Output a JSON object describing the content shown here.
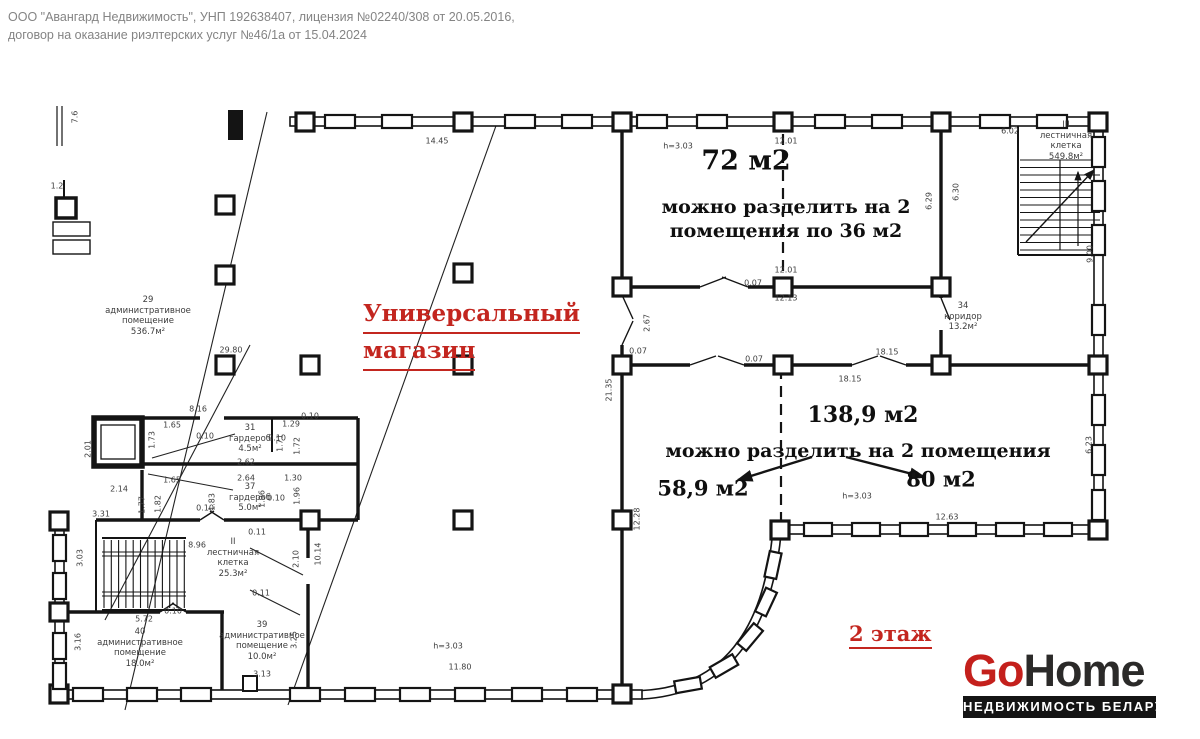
{
  "header": {
    "line1": "ООО \"Авангард Недвижимость\", УНП 192638407, лицензия №02240/308 от 20.05.2016,",
    "line2": "договор на оказание риэлтерских услуг №46/1а от 15.04.2024"
  },
  "colors": {
    "accent_red": "#c3261f",
    "logo_red": "#c4201c",
    "logo_dark": "#2b2a29",
    "line": "#141414",
    "tagline_bg": "#141414"
  },
  "plan": {
    "title": {
      "line1": "Универсальный",
      "line2": "магазин"
    },
    "floor_label": "2 этаж",
    "notes": [
      {
        "t": "72 м2",
        "x": 746,
        "y": 161,
        "s": 27
      },
      {
        "t": "можно разделить на 2",
        "x": 786,
        "y": 207,
        "s": 19
      },
      {
        "t": "помещения по 36 м2",
        "x": 786,
        "y": 231,
        "s": 19
      },
      {
        "t": "138,9 м2",
        "x": 863,
        "y": 415,
        "s": 22
      },
      {
        "t": "можно разделить на 2 помещения",
        "x": 858,
        "y": 451,
        "s": 19
      },
      {
        "t": "58,9 м2",
        "x": 703,
        "y": 488,
        "s": 21
      },
      {
        "t": "80 м2",
        "x": 941,
        "y": 479,
        "s": 21
      }
    ],
    "rooms": [
      {
        "x": 148,
        "y": 295,
        "lines": [
          "29",
          "административное",
          "помещение",
          "536.7м²"
        ]
      },
      {
        "x": 250,
        "y": 423,
        "lines": [
          "31",
          "гардероб",
          "4.5м²"
        ]
      },
      {
        "x": 250,
        "y": 482,
        "lines": [
          "37",
          "гардероб",
          "5.0м²"
        ]
      },
      {
        "x": 233,
        "y": 537,
        "lines": [
          "II",
          "лестничная",
          "клетка",
          "25.3м²"
        ]
      },
      {
        "x": 140,
        "y": 627,
        "lines": [
          "40",
          "административное",
          "помещение",
          "18.0м²"
        ]
      },
      {
        "x": 262,
        "y": 620,
        "lines": [
          "39",
          "административное",
          "помещение",
          "10.0м²"
        ]
      },
      {
        "x": 963,
        "y": 301,
        "lines": [
          "34",
          "коридор",
          "13.2м²"
        ]
      },
      {
        "x": 1066,
        "y": 120,
        "lines": [
          "III",
          "лестничная",
          "клетка",
          "549.8м²"
        ]
      }
    ],
    "dimensions": [
      {
        "t": "7.6",
        "x": 75,
        "y": 117,
        "r": 90
      },
      {
        "t": "1.2",
        "x": 57,
        "y": 186,
        "r": 0
      },
      {
        "t": "14.45",
        "x": 437,
        "y": 141,
        "r": 0
      },
      {
        "t": "h=3.03",
        "x": 678,
        "y": 146,
        "r": 0
      },
      {
        "t": "12.01",
        "x": 786,
        "y": 141,
        "r": 0
      },
      {
        "t": "6.02",
        "x": 1010,
        "y": 131,
        "r": 0
      },
      {
        "t": "6.29",
        "x": 929,
        "y": 201,
        "r": 90
      },
      {
        "t": "6.30",
        "x": 956,
        "y": 192,
        "r": 90
      },
      {
        "t": "9.00",
        "x": 1090,
        "y": 254,
        "r": 90
      },
      {
        "t": "12.01",
        "x": 786,
        "y": 270,
        "r": 0
      },
      {
        "t": "0.07",
        "x": 753,
        "y": 283,
        "r": 0
      },
      {
        "t": "12.13",
        "x": 786,
        "y": 298,
        "r": 0
      },
      {
        "t": "2.67",
        "x": 647,
        "y": 323,
        "r": 90
      },
      {
        "t": "0.07",
        "x": 638,
        "y": 351,
        "r": 0
      },
      {
        "t": "0.07",
        "x": 754,
        "y": 359,
        "r": 0
      },
      {
        "t": "18.15",
        "x": 887,
        "y": 352,
        "r": 0
      },
      {
        "t": "18.15",
        "x": 850,
        "y": 379,
        "r": 0
      },
      {
        "t": "21.35",
        "x": 609,
        "y": 390,
        "r": 90
      },
      {
        "t": "29.80",
        "x": 231,
        "y": 350,
        "r": 0
      },
      {
        "t": "8.16",
        "x": 198,
        "y": 409,
        "r": 0
      },
      {
        "t": "1.65",
        "x": 172,
        "y": 425,
        "r": 0
      },
      {
        "t": "0.10",
        "x": 205,
        "y": 436,
        "r": 0
      },
      {
        "t": "0.10",
        "x": 310,
        "y": 416,
        "r": 0
      },
      {
        "t": "0.10",
        "x": 277,
        "y": 438,
        "r": 0
      },
      {
        "t": "1.29",
        "x": 291,
        "y": 424,
        "r": 0
      },
      {
        "t": "1.71",
        "x": 280,
        "y": 443,
        "r": 90
      },
      {
        "t": "1.72",
        "x": 297,
        "y": 446,
        "r": 90
      },
      {
        "t": "1.73",
        "x": 152,
        "y": 440,
        "r": 90
      },
      {
        "t": "2.62",
        "x": 246,
        "y": 462,
        "r": 0
      },
      {
        "t": "1.65",
        "x": 172,
        "y": 480,
        "r": 0
      },
      {
        "t": "2.64",
        "x": 246,
        "y": 478,
        "r": 0
      },
      {
        "t": "1.30",
        "x": 293,
        "y": 478,
        "r": 0
      },
      {
        "t": "1.77",
        "x": 142,
        "y": 505,
        "r": 90
      },
      {
        "t": "1.82",
        "x": 158,
        "y": 504,
        "r": 90
      },
      {
        "t": "1.83",
        "x": 212,
        "y": 502,
        "r": 90
      },
      {
        "t": "1.96",
        "x": 262,
        "y": 499,
        "r": 90
      },
      {
        "t": "1.96",
        "x": 297,
        "y": 496,
        "r": 90
      },
      {
        "t": "0.10",
        "x": 276,
        "y": 498,
        "r": 0
      },
      {
        "t": "0.10",
        "x": 205,
        "y": 508,
        "r": 0
      },
      {
        "t": "2.01",
        "x": 88,
        "y": 449,
        "r": 90
      },
      {
        "t": "2.14",
        "x": 119,
        "y": 489,
        "r": 0
      },
      {
        "t": "3.31",
        "x": 101,
        "y": 514,
        "r": 0
      },
      {
        "t": "8.96",
        "x": 197,
        "y": 545,
        "r": 0
      },
      {
        "t": "3.03",
        "x": 80,
        "y": 558,
        "r": 90
      },
      {
        "t": "0.11",
        "x": 257,
        "y": 532,
        "r": 0
      },
      {
        "t": "0.11",
        "x": 261,
        "y": 593,
        "r": 0
      },
      {
        "t": "10.14",
        "x": 318,
        "y": 554,
        "r": 90
      },
      {
        "t": "2.10",
        "x": 296,
        "y": 559,
        "r": 90
      },
      {
        "t": "5.72",
        "x": 144,
        "y": 619,
        "r": 0
      },
      {
        "t": "0.10",
        "x": 173,
        "y": 611,
        "r": 0
      },
      {
        "t": "3.16",
        "x": 78,
        "y": 642,
        "r": 90
      },
      {
        "t": "3.25",
        "x": 294,
        "y": 640,
        "r": 90
      },
      {
        "t": "3.13",
        "x": 262,
        "y": 674,
        "r": 0
      },
      {
        "t": "11.80",
        "x": 460,
        "y": 667,
        "r": 0
      },
      {
        "t": "h=3.03",
        "x": 448,
        "y": 646,
        "r": 0
      },
      {
        "t": "12.28",
        "x": 637,
        "y": 519,
        "r": 90
      },
      {
        "t": "12.63",
        "x": 947,
        "y": 517,
        "r": 0
      },
      {
        "t": "h=3.03",
        "x": 857,
        "y": 496,
        "r": 0
      },
      {
        "t": "6.23",
        "x": 1089,
        "y": 445,
        "r": 90
      }
    ]
  },
  "logo": {
    "go": "Go",
    "home": "Home",
    "tagline": "НЕДВИЖИМОСТЬ БЕЛАРУСИ"
  }
}
